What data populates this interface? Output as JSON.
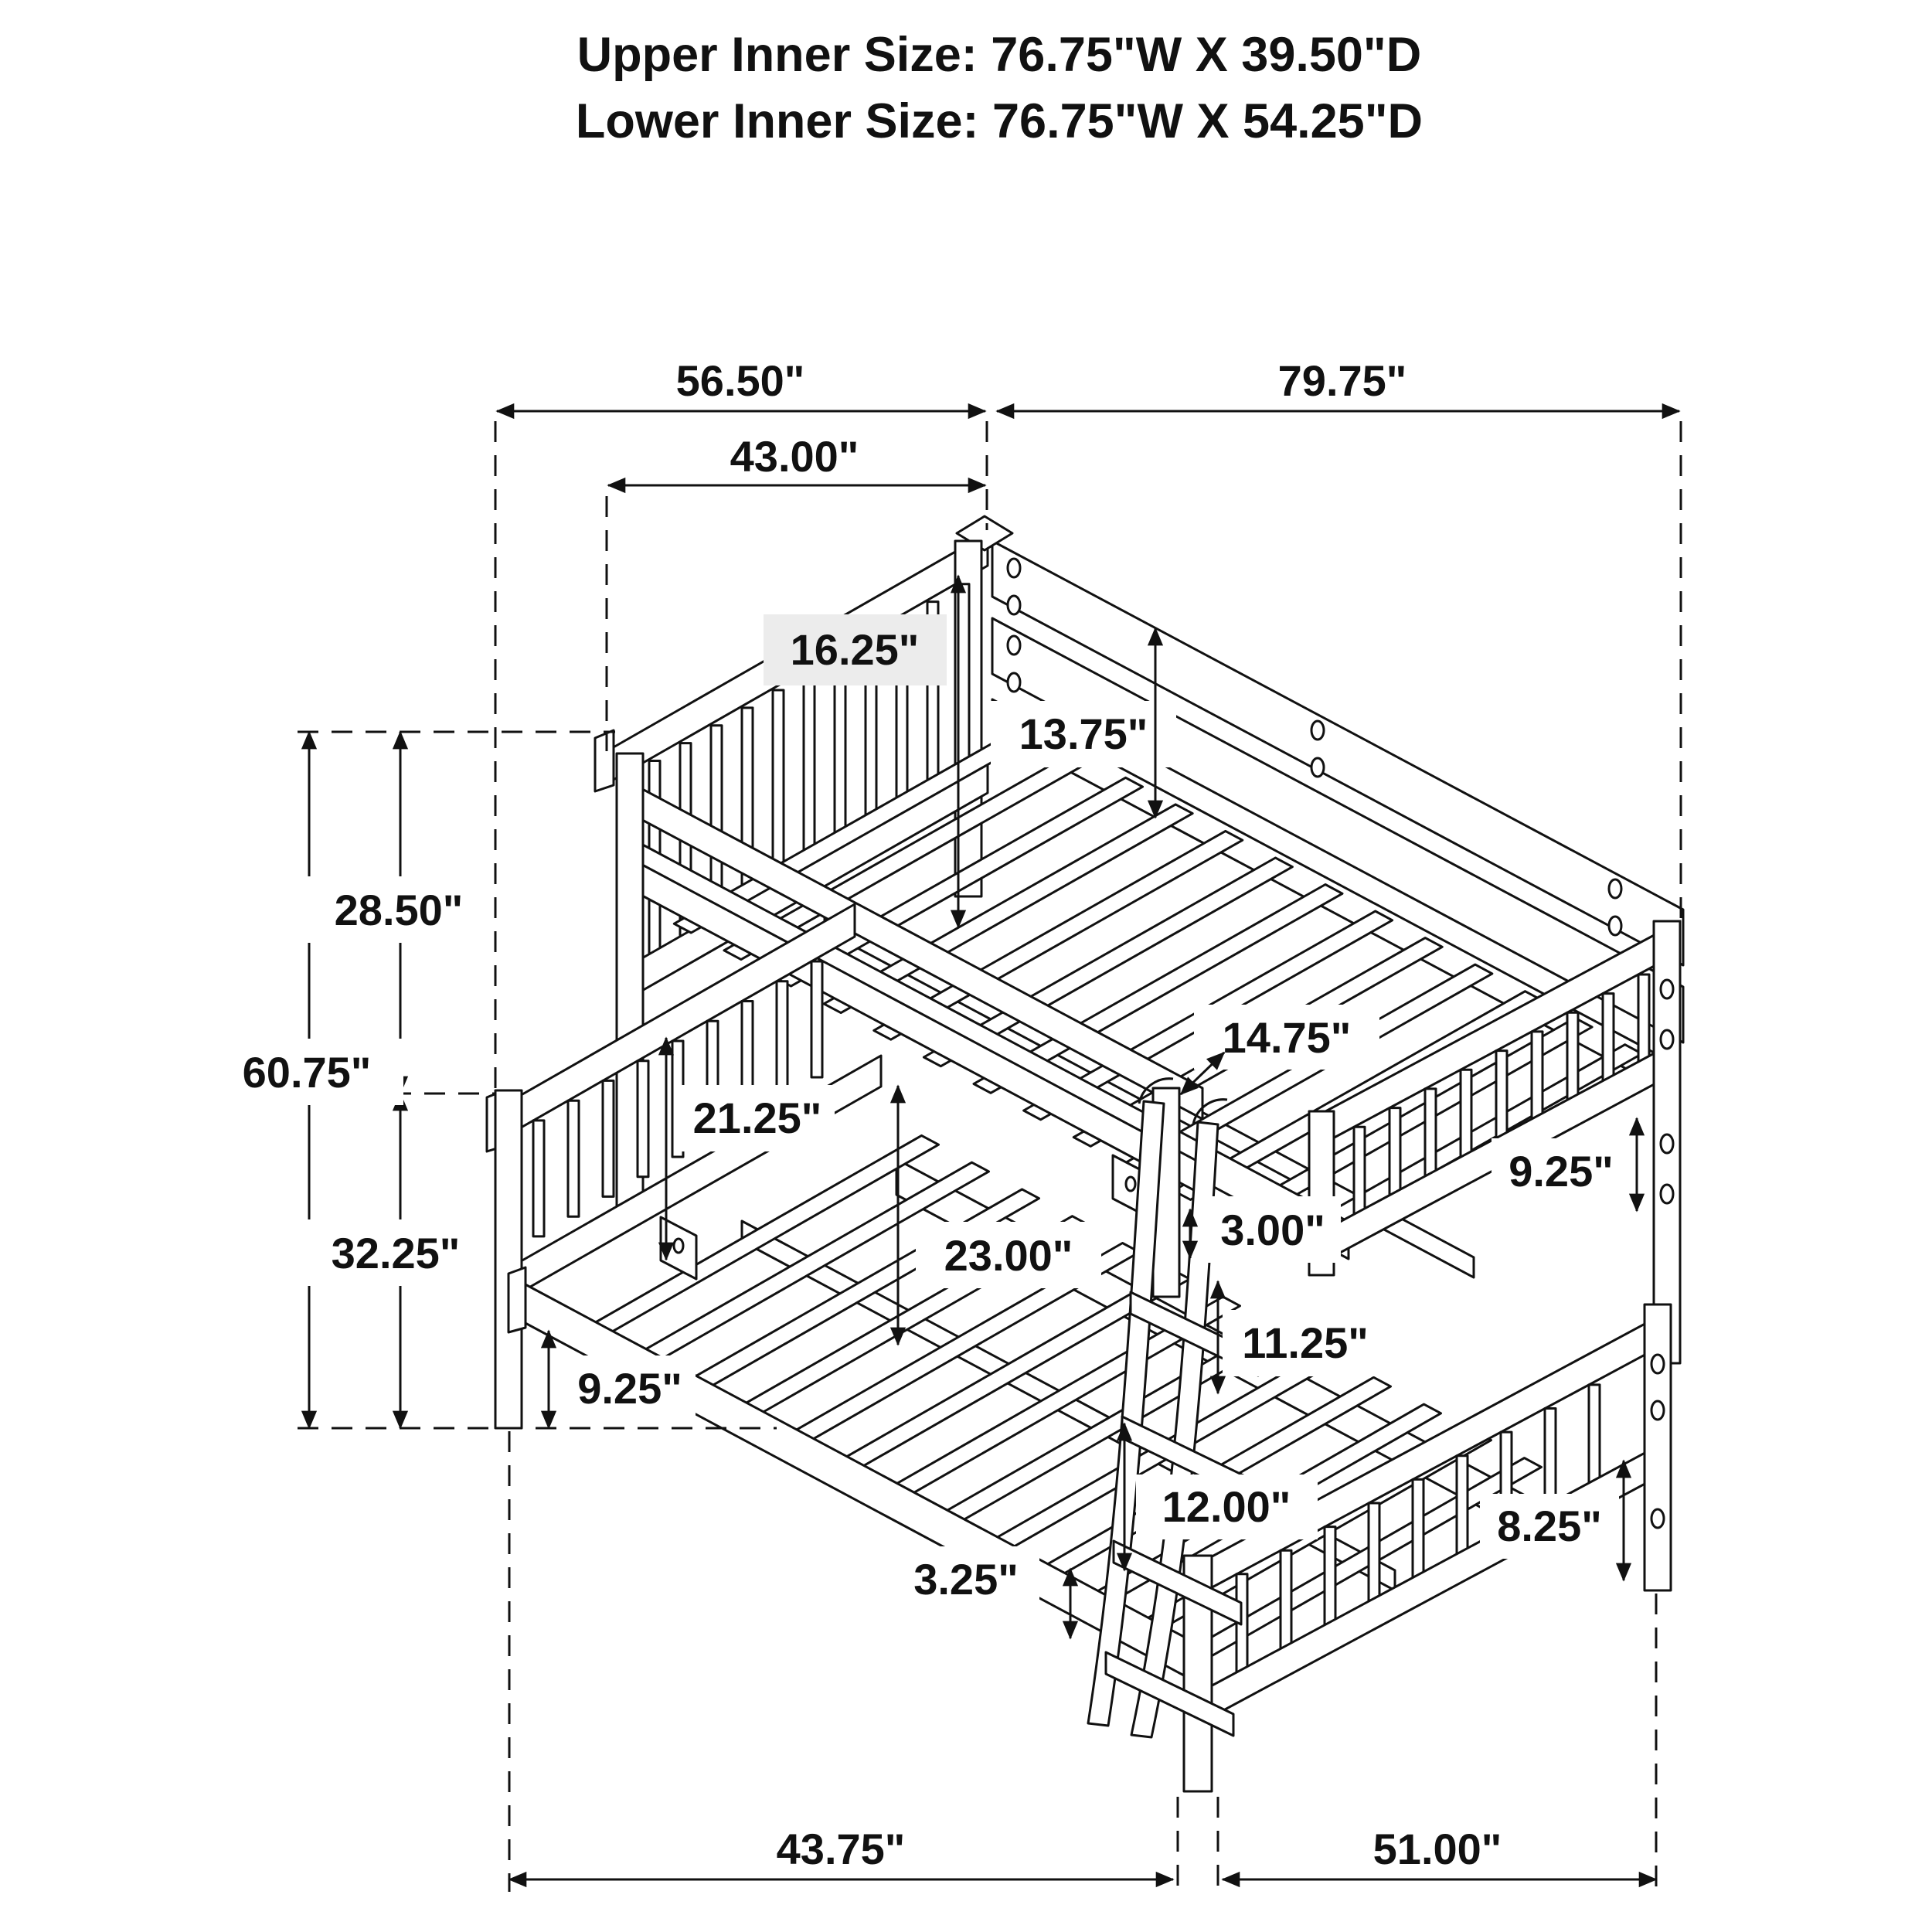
{
  "title": {
    "line1": "Upper Inner Size: 76.75\"W X 39.50\"D",
    "line2": "Lower Inner Size: 76.75\"W X 54.25\"D"
  },
  "dims": {
    "top_width_left": "56.50\"",
    "top_width_right": "79.75\"",
    "headboard_width": "43.00\"",
    "upper_headboard_height": "16.25\"",
    "upper_rail_height": "13.75\"",
    "upper_section_height": "28.50\"",
    "total_height": "60.75\"",
    "lower_section_height": "32.25\"",
    "rail_to_rail": "21.25\"",
    "guard_rail_gap": "14.75\"",
    "upper_footboard_rail": "9.25\"",
    "rail_thickness": "3.00\"",
    "bunk_clearance": "23.00\"",
    "rung_spacing": "11.25\"",
    "lower_rail_height": "9.25\"",
    "ladder_step": "12.00\"",
    "lower_footboard_rail": "8.25\"",
    "bottom_step": "3.25\"",
    "bottom_width_left": "43.75\"",
    "bottom_width_right": "51.00\""
  },
  "colors": {
    "line": "#111111",
    "label_bg": "#ffffff",
    "label_bg_gray": "#ececec"
  }
}
